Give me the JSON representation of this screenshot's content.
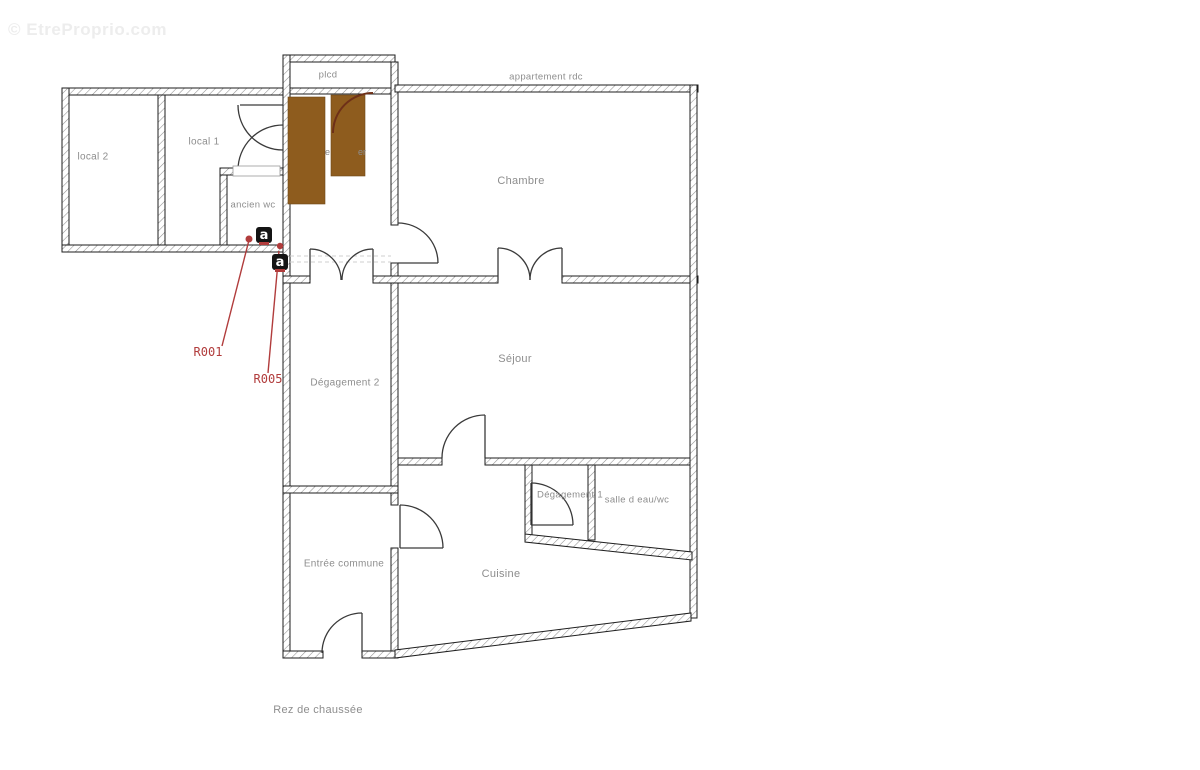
{
  "watermark": "© EtreProprio.com",
  "plan": {
    "floor_label": "Rez de chaussée",
    "area_label": "appartement rdc"
  },
  "rooms": {
    "local2": {
      "label": "local 2"
    },
    "local1": {
      "label": "local 1"
    },
    "ancien_wc": {
      "label": "ancien wc"
    },
    "plcd": {
      "label": "plcd"
    },
    "chambre": {
      "label": "Chambre"
    },
    "sejour": {
      "label": "Séjour"
    },
    "degagement2": {
      "label": "Dégagement 2"
    },
    "entree_commune": {
      "label": "Entrée commune"
    },
    "cuisine": {
      "label": "Cuisine"
    },
    "degagement1": {
      "label": "Dégagement 1"
    },
    "salle_eau_wc": {
      "label": "salle d eau/wc"
    }
  },
  "annotations": {
    "r001": "R001",
    "r005": "R005",
    "marker_letter": "a",
    "stair_text_fragment_1": "e",
    "stair_text_fragment_2": "er"
  },
  "colors": {
    "stairs_fill": "#8e5c1e",
    "stairs_edge": "#6f4717",
    "stair_arc": "#6e3018",
    "annotation_red": "#b13c3c",
    "wall_line": "#1d1d1d",
    "hatch_gray": "#8f8f8f",
    "label_gray": "#8d8d8d",
    "watermark_gray": "#ededed"
  }
}
